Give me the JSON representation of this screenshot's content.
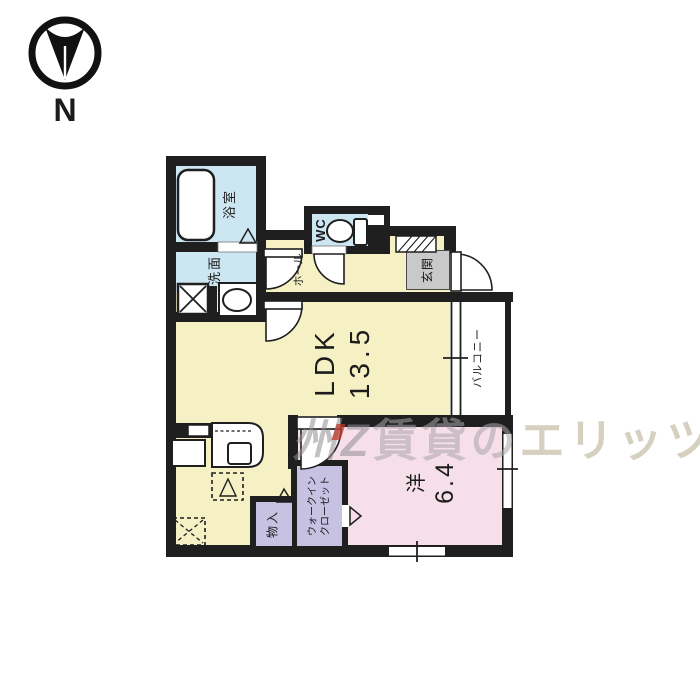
{
  "compass": {
    "label": "N"
  },
  "rooms": {
    "bath": {
      "label": "浴室"
    },
    "washroom": {
      "label": "洗面"
    },
    "wc": {
      "label": "WC"
    },
    "hall": {
      "label": "ホール"
    },
    "entrance": {
      "label": "玄関"
    },
    "ldk": {
      "label": "LDK",
      "size": "13.5"
    },
    "western": {
      "label": "洋",
      "size": "6.4"
    },
    "balcony": {
      "label": "バルコニー"
    },
    "storage": {
      "label": "物入"
    },
    "walk_in_closet": {
      "label_line1": "ウォークイン",
      "label_line2": "クローゼット"
    }
  },
  "watermark": {
    "logo": "州Z",
    "gray_text": "賃貸の",
    "tan_text": "エリッツ"
  },
  "colors": {
    "room_yellow": "#f6f0c5",
    "room_blue": "#cde7f2",
    "room_pink": "#f6dfe9",
    "closet_lavender": "#c8c2e2",
    "entrance_gray": "#c9c9c9",
    "wall_black": "#1f1f1f",
    "watermark_gray": "#a8a4a8",
    "watermark_tan": "#b5aa8d"
  }
}
